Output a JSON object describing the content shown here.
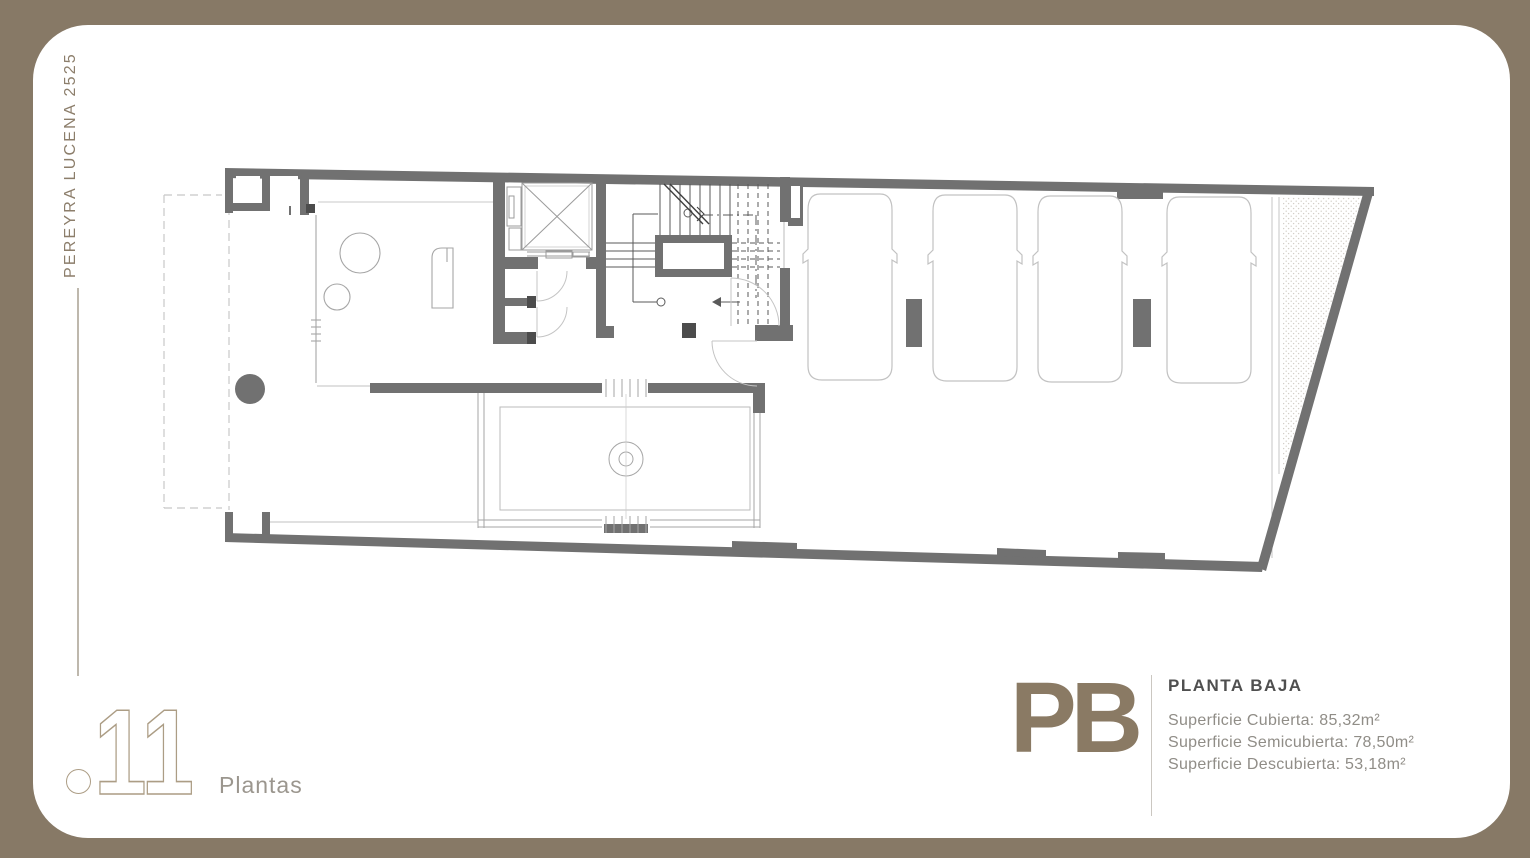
{
  "frame": {
    "background": "#877966",
    "canvas": "#FFFFFF"
  },
  "side_label": {
    "text": "PEREYRA LUCENA 2525"
  },
  "footer_left": {
    "number": "11",
    "label": "Plantas"
  },
  "footer_right": {
    "code": "PB",
    "title": "PLANTA BAJA",
    "areas": [
      "Superficie Cubierta: 85,32m²",
      "Superficie Semicubierta: 78,50m²",
      "Superficie Descubierta: 53,18m²"
    ]
  },
  "plan_colors": {
    "walls": "#717171",
    "thin_lines": "#A6A6A6",
    "accent": "#8A7A64"
  }
}
